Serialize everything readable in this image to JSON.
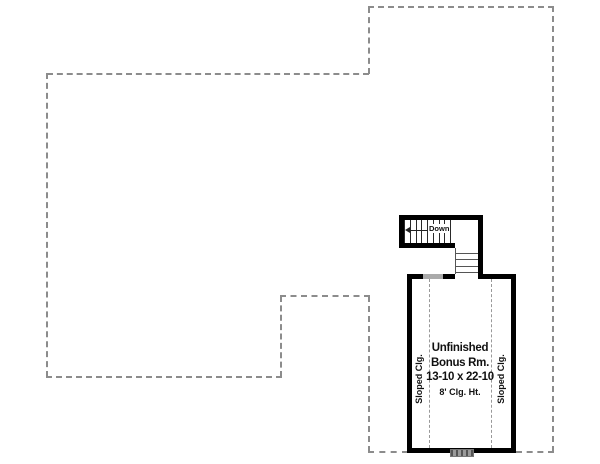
{
  "plan": {
    "room": {
      "name_line1": "Unfinished",
      "name_line2": "Bonus Rm.",
      "dimensions": "13-10 x 22-10",
      "ceiling_height": "8' Clg. Ht.",
      "sloped_ceiling_left": "Sloped Clg.",
      "sloped_ceiling_right": "Sloped Clg."
    },
    "stairs": {
      "down_label": "Down",
      "upper_riser_count": 9,
      "lower_tread_count": 4
    },
    "colors": {
      "wall": "#000000",
      "outline_dash": "#8c8c8c",
      "ceiling_dash": "#999999",
      "knee_wall_gray": "#aaaaaa",
      "background": "#ffffff"
    }
  }
}
